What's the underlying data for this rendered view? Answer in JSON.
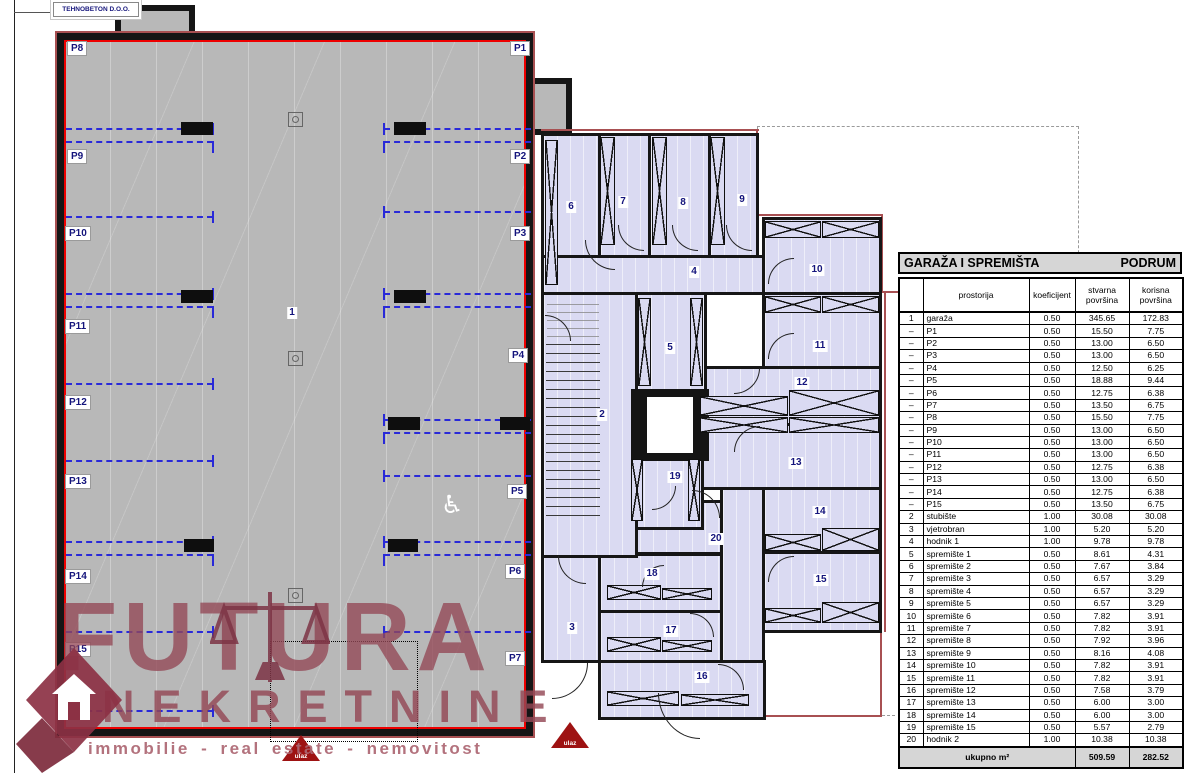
{
  "title_block": {
    "company": "TEHNOBETON D.O.O."
  },
  "watermark": {
    "line1": "FUTURA",
    "line2": "NEKRETNINE",
    "tagline": "immobilie - real estate - nemovitost"
  },
  "plan": {
    "garage_number": "1",
    "entrance_label": "ulaz",
    "wheelchair_icon": "♿",
    "parking": {
      "p1": "P1",
      "p2": "P2",
      "p3": "P3",
      "p4": "P4",
      "p5": "P5",
      "p6": "P6",
      "p7": "P7",
      "p8": "P8",
      "p9": "P9",
      "p10": "P10",
      "p11": "P11",
      "p12": "P12",
      "p13": "P13",
      "p14": "P14",
      "p15": "P15"
    },
    "rooms": {
      "n2": "2",
      "n3": "3",
      "n4": "4",
      "n5": "5",
      "n6": "6",
      "n7": "7",
      "n8": "8",
      "n9": "9",
      "n10": "10",
      "n11": "11",
      "n12": "12",
      "n13": "13",
      "n14": "14",
      "n15": "15",
      "n16": "16",
      "n17": "17",
      "n18": "18",
      "n19": "19",
      "n20": "20"
    }
  },
  "table": {
    "title_left": "GARAŽA I SPREMIŠTA",
    "title_right": "PODRUM",
    "columns": [
      "",
      "prostorija",
      "koeficijent",
      "stvarna\npovršina",
      "korisna\npovršina"
    ],
    "rows": [
      [
        "1",
        "garaža",
        "0.50",
        "345.65",
        "172.83"
      ],
      [
        "–",
        "P1",
        "0.50",
        "15.50",
        "7.75"
      ],
      [
        "–",
        "P2",
        "0.50",
        "13.00",
        "6.50"
      ],
      [
        "–",
        "P3",
        "0.50",
        "13.00",
        "6.50"
      ],
      [
        "–",
        "P4",
        "0.50",
        "12.50",
        "6.25"
      ],
      [
        "–",
        "P5",
        "0.50",
        "18.88",
        "9.44"
      ],
      [
        "–",
        "P6",
        "0.50",
        "12.75",
        "6.38"
      ],
      [
        "–",
        "P7",
        "0.50",
        "13.50",
        "6.75"
      ],
      [
        "–",
        "P8",
        "0.50",
        "15.50",
        "7.75"
      ],
      [
        "–",
        "P9",
        "0.50",
        "13.00",
        "6.50"
      ],
      [
        "–",
        "P10",
        "0.50",
        "13.00",
        "6.50"
      ],
      [
        "–",
        "P11",
        "0.50",
        "13.00",
        "6.50"
      ],
      [
        "–",
        "P12",
        "0.50",
        "12.75",
        "6.38"
      ],
      [
        "–",
        "P13",
        "0.50",
        "13.00",
        "6.50"
      ],
      [
        "–",
        "P14",
        "0.50",
        "12.75",
        "6.38"
      ],
      [
        "–",
        "P15",
        "0.50",
        "13.50",
        "6.75"
      ],
      [
        "2",
        "stubište",
        "1.00",
        "30.08",
        "30.08"
      ],
      [
        "3",
        "vjetrobran",
        "1.00",
        "5.20",
        "5.20"
      ],
      [
        "4",
        "hodnik 1",
        "1.00",
        "9.78",
        "9.78"
      ],
      [
        "5",
        "spremište 1",
        "0.50",
        "8.61",
        "4.31"
      ],
      [
        "6",
        "spremište 2",
        "0.50",
        "7.67",
        "3.84"
      ],
      [
        "7",
        "spremište 3",
        "0.50",
        "6.57",
        "3.29"
      ],
      [
        "8",
        "spremište 4",
        "0.50",
        "6.57",
        "3.29"
      ],
      [
        "9",
        "spremište 5",
        "0.50",
        "6.57",
        "3.29"
      ],
      [
        "10",
        "spremište 6",
        "0.50",
        "7.82",
        "3.91"
      ],
      [
        "11",
        "spremište 7",
        "0.50",
        "7.82",
        "3.91"
      ],
      [
        "12",
        "spremište 8",
        "0.50",
        "7.92",
        "3.96"
      ],
      [
        "13",
        "spremište 9",
        "0.50",
        "8.16",
        "4.08"
      ],
      [
        "14",
        "spremište 10",
        "0.50",
        "7.82",
        "3.91"
      ],
      [
        "15",
        "spremište 11",
        "0.50",
        "7.82",
        "3.91"
      ],
      [
        "16",
        "spremište 12",
        "0.50",
        "7.58",
        "3.79"
      ],
      [
        "17",
        "spremište 13",
        "0.50",
        "6.00",
        "3.00"
      ],
      [
        "18",
        "spremište 14",
        "0.50",
        "6.00",
        "3.00"
      ],
      [
        "19",
        "spremište 15",
        "0.50",
        "5.57",
        "2.79"
      ],
      [
        "20",
        "hodnik 2",
        "1.00",
        "10.38",
        "10.38"
      ]
    ],
    "footer": {
      "label": "ukupno m²",
      "stvarna": "509.59",
      "korisna": "282.52"
    }
  },
  "colors": {
    "garage_fill": "#b8b8b8",
    "storage_fill": "#dadaf2",
    "wall": "#151515",
    "inner_red": "#ee0000",
    "outline_red": "#a85052",
    "parking_dash_blue": "#2929d8",
    "label_navy": "#14147c",
    "table_header_gray": "#d6d6d6",
    "watermark_maroon": "#94485a",
    "entrance_red": "#9e1212"
  }
}
